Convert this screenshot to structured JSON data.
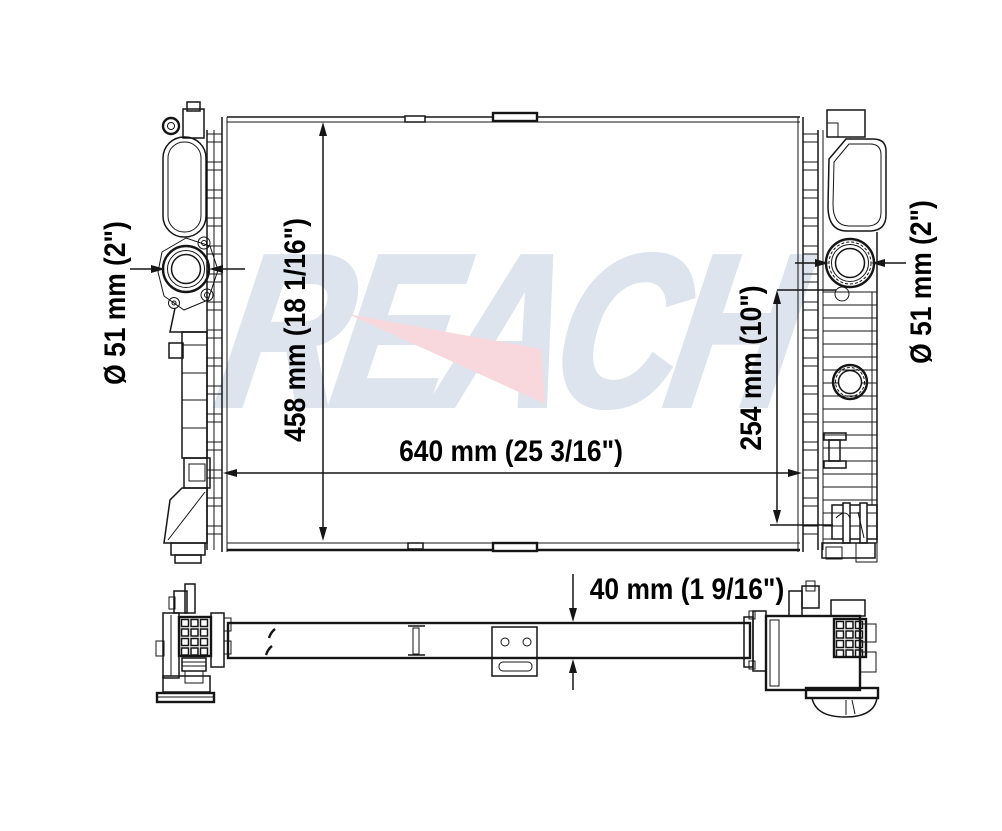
{
  "meta": {
    "type": "technical-drawing",
    "subject": "radiator front and bottom views"
  },
  "watermark": {
    "text": "REACH"
  },
  "colors": {
    "background": "#ffffff",
    "line": "#151515",
    "label": "#000000",
    "watermark": "#dde4ee",
    "swoosh": "#f8d8dc"
  },
  "labels": {
    "left_port": "Ø 51 mm (2\")",
    "core_height": "458 mm (18 1/16\")",
    "core_width": "640 mm (25 3/16\")",
    "port_offset": "254 mm (10\")",
    "right_port": "Ø 51 mm (2\")",
    "thickness": "40 mm (1 9/16\")"
  }
}
